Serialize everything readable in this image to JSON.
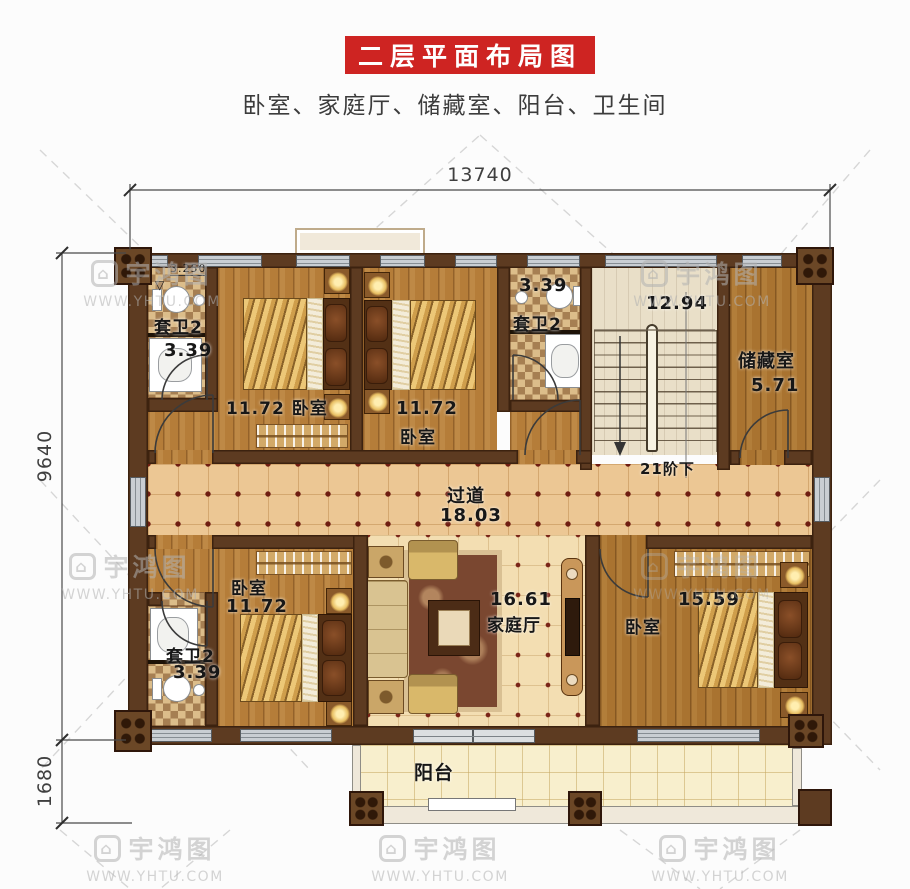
{
  "header": {
    "title": "二层平面布局图",
    "subtitle": "卧室、家庭厅、储藏室、阳台、卫生间"
  },
  "dimensions": {
    "top_width": "13740",
    "left_height_main": "9640",
    "left_height_balcony": "1680"
  },
  "rooms": {
    "bath_top_left": {
      "name": "套卫2",
      "area": "3.39",
      "floor_level": "3.250"
    },
    "bedroom_top_left": {
      "name": "卧室",
      "area": "11.72"
    },
    "bedroom_top_mid": {
      "name": "卧室",
      "area": "11.72"
    },
    "bath_top_right": {
      "name": "套卫2",
      "area": "3.39"
    },
    "stairwell": {
      "area": "12.94",
      "steps_note": "21阶下"
    },
    "storage": {
      "name": "储藏室",
      "area": "5.71"
    },
    "corridor": {
      "name": "过道",
      "area": "18.03"
    },
    "family_hall": {
      "name": "家庭厅",
      "area": "16.61"
    },
    "bedroom_bottom_left": {
      "name": "卧室",
      "area": "11.72"
    },
    "bath_bottom_left": {
      "name": "套卫2",
      "area": "3.39"
    },
    "bedroom_bottom_right": {
      "name": "卧室",
      "area": "15.59"
    },
    "balcony": {
      "name": "阳台"
    }
  },
  "icons": {
    "level_marker": "▽",
    "watermark_logo": "⌂"
  },
  "watermark": {
    "brand": "宇鸿图",
    "url": "WWW.YHTU.COM"
  },
  "colors": {
    "title_bg": "#ce2422",
    "wall": "#5d3b21",
    "window_glass": "#c9ced3",
    "corridor_dot": "#6f1d11"
  }
}
